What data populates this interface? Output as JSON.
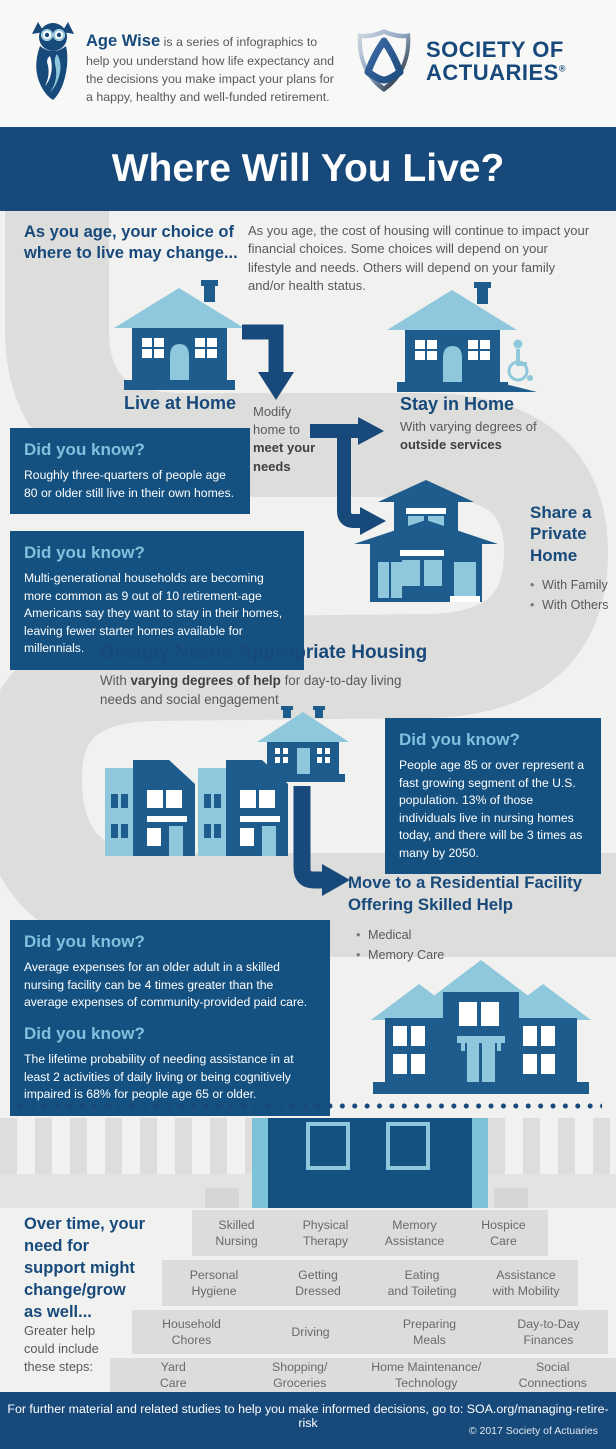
{
  "header": {
    "brand": "Age Wise",
    "brand_desc": " is a series of infographics to help you understand how life expectancy and the decisions you make impact your plans for a happy, healthy and well-funded retirement.",
    "org_line1": "SOCIETY OF",
    "org_line2": "ACTUARIES",
    "org_reg": "®"
  },
  "title": "Where Will You Live?",
  "intro": {
    "heading": "As you age, your choice of where to live may change...",
    "body": "As you age, the cost of housing will continue to impact your financial choices. Some choices will depend on your lifestyle and needs. Others will depend on your family and/or health status."
  },
  "stages": {
    "live_at_home": "Live at Home",
    "modify_pre": "Modify home to ",
    "modify_bold": "meet your needs",
    "stay_heading": "Stay in Home",
    "stay_pre": "With varying degrees of ",
    "stay_bold": "outside services",
    "share_heading": "Share a Private Home",
    "share_bullets": [
      "With Family",
      "With Others"
    ],
    "occupy_heading": "Occupy Needs-Appropriate Housing",
    "occupy_pre": "With ",
    "occupy_bold": "varying degrees of help",
    "occupy_post": " for day-to-day living needs and social engagement",
    "move_heading": "Move to a Residential Facility Offering Skilled Help",
    "move_bullets": [
      "Medical",
      "Memory Care"
    ]
  },
  "facts": [
    {
      "heading": "Did you know?",
      "text": "Roughly three-quarters of people age 80 or older still live in their own homes."
    },
    {
      "heading": "Did you know?",
      "text": "Multi-generational households are becoming more common as 9 out of 10 retirement-age Americans say they want to stay in their homes, leaving fewer starter homes available for millennials."
    },
    {
      "heading": "Did you know?",
      "text": "People age 85 or over represent a fast growing segment of the U.S. population. 13% of those individuals live in nursing homes today, and there will be 3 times as many by 2050."
    },
    {
      "heading": "Did you know?",
      "text": "Average expenses for an older adult in a skilled nursing facility can be 4 times greater than the average expenses of community-provided paid care."
    },
    {
      "heading": "Did you know?",
      "text": "The lifetime probability of needing assistance in at least 2 activities of daily living or being cognitively impaired is 68% for people age 65 or older."
    }
  ],
  "support": {
    "heading": "Over time, your need for support might change/grow as well...",
    "note": "Greater help could include these steps:",
    "rows": [
      [
        "Skilled\nNursing",
        "Physical\nTherapy",
        "Memory\nAssistance",
        "Hospice\nCare"
      ],
      [
        "Personal\nHygiene",
        "Getting\nDressed",
        "Eating\nand Toileting",
        "Assistance\nwith Mobility"
      ],
      [
        "Household\nChores",
        "Driving",
        "Preparing\nMeals",
        "Day-to-Day\nFinances"
      ],
      [
        "Yard\nCare",
        "Shopping/\nGroceries",
        "Home Maintenance/\nTechnology",
        "Social\nConnections"
      ]
    ]
  },
  "footer": {
    "text": "For further material and related studies to help you make informed decisions, go to: SOA.org/managing-retire-risk",
    "copyright": "© 2017 Society of Actuaries"
  },
  "colors": {
    "navy": "#17497b",
    "box_navy": "#155180",
    "house_blue": "#1d5c8c",
    "light_blue": "#8fc8dd",
    "teal": "#7cc2d8",
    "road_gray": "#dddddb",
    "text_gray": "#58595b"
  }
}
